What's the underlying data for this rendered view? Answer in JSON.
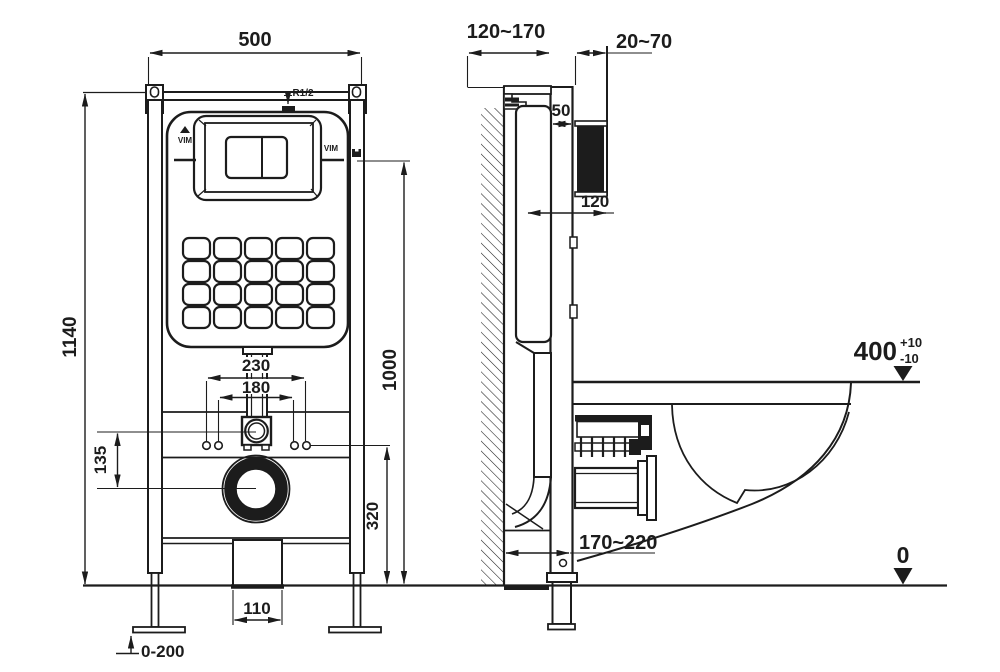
{
  "colors": {
    "ink": "#1c1c1c",
    "paper": "#ffffff"
  },
  "front": {
    "width": "500",
    "total_height": "1140",
    "panel_height": "1000",
    "outlet_height": "320",
    "inlet_outlet_offset": "135",
    "fixing_outer": "230",
    "fixing_inner": "180",
    "drain_width": "110",
    "feet_range": "0-200",
    "inlet_thread": "R1/2",
    "brand_left": "VIM",
    "brand_right": "VIM"
  },
  "side": {
    "depth_range": "120~170",
    "finish_range": "20~70",
    "plate_gap": "50",
    "cistern_depth": "120",
    "drain_offset": "170~220",
    "rim_height": "400",
    "rim_tol_plus": "+10",
    "rim_tol_minus": "-10",
    "floor_level": "0"
  }
}
